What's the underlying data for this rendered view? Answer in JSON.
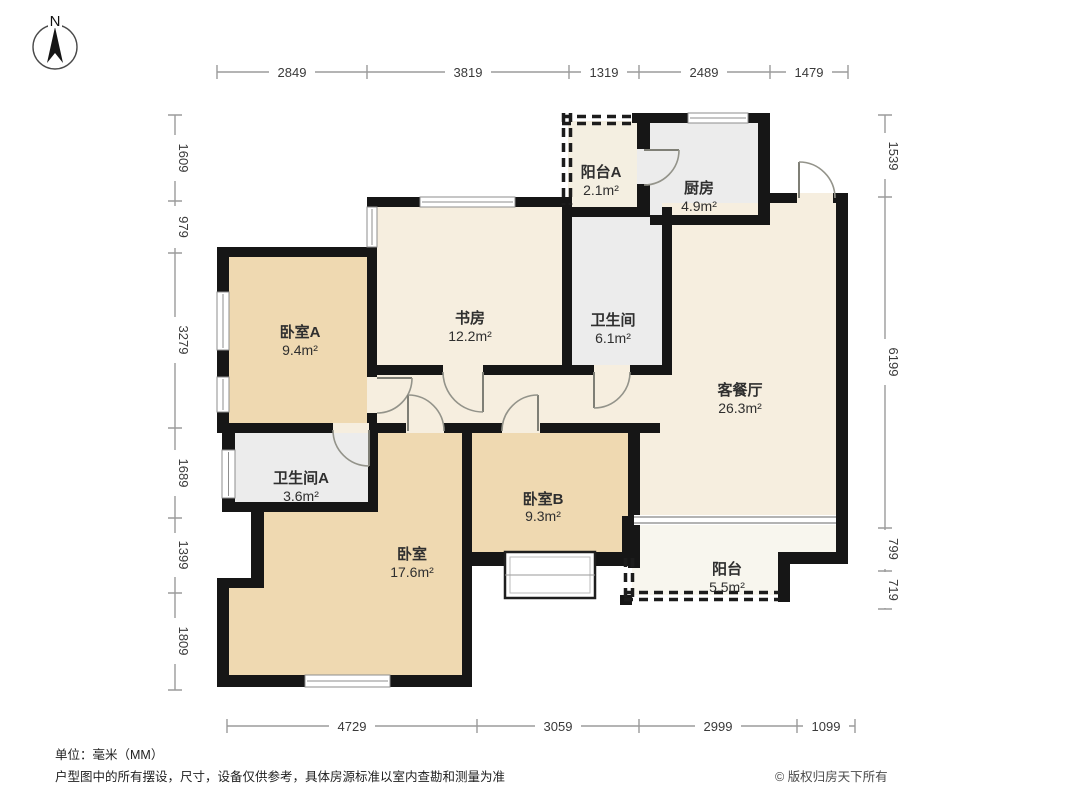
{
  "compass": {
    "label": "N"
  },
  "rooms": [
    {
      "id": "balcony-a",
      "name": "阳台A",
      "area": "2.1m²"
    },
    {
      "id": "kitchen",
      "name": "厨房",
      "area": "4.9m²"
    },
    {
      "id": "bedroom-a",
      "name": "卧室A",
      "area": "9.4m²"
    },
    {
      "id": "study",
      "name": "书房",
      "area": "12.2m²"
    },
    {
      "id": "bathroom",
      "name": "卫生间",
      "area": "6.1m²"
    },
    {
      "id": "living-dining",
      "name": "客餐厅",
      "area": "26.3m²"
    },
    {
      "id": "bathroom-a",
      "name": "卫生间A",
      "area": "3.6m²"
    },
    {
      "id": "bedroom-b",
      "name": "卧室B",
      "area": "9.3m²"
    },
    {
      "id": "bedroom",
      "name": "卧室",
      "area": "17.6m²"
    },
    {
      "id": "balcony",
      "name": "阳台",
      "area": "5.5m²"
    }
  ],
  "dimensions": {
    "top": [
      "2849",
      "3819",
      "1319",
      "2489",
      "1479"
    ],
    "bottom": [
      "4729",
      "3059",
      "2999",
      "1099"
    ],
    "left": [
      "1609",
      "979",
      "3279",
      "1689",
      "1399",
      "1809"
    ],
    "right": [
      "1539",
      "6199",
      "799",
      "719"
    ]
  },
  "footer": {
    "unit_note": "单位：毫米（MM）",
    "disclaimer": "户型图中的所有摆设，尺寸，设备仅供参考，具体房源标准以室内查勘和测量为准",
    "copyright": "© 版权归房天下所有"
  },
  "colors": {
    "wall": "#161616",
    "bedroom_fill": "#efd9b1",
    "living_fill": "#f6eedf",
    "wet_fill": "#ececec",
    "balcony_a_fill": "#f4efe1",
    "balcony_fill": "#f8f6ee"
  }
}
